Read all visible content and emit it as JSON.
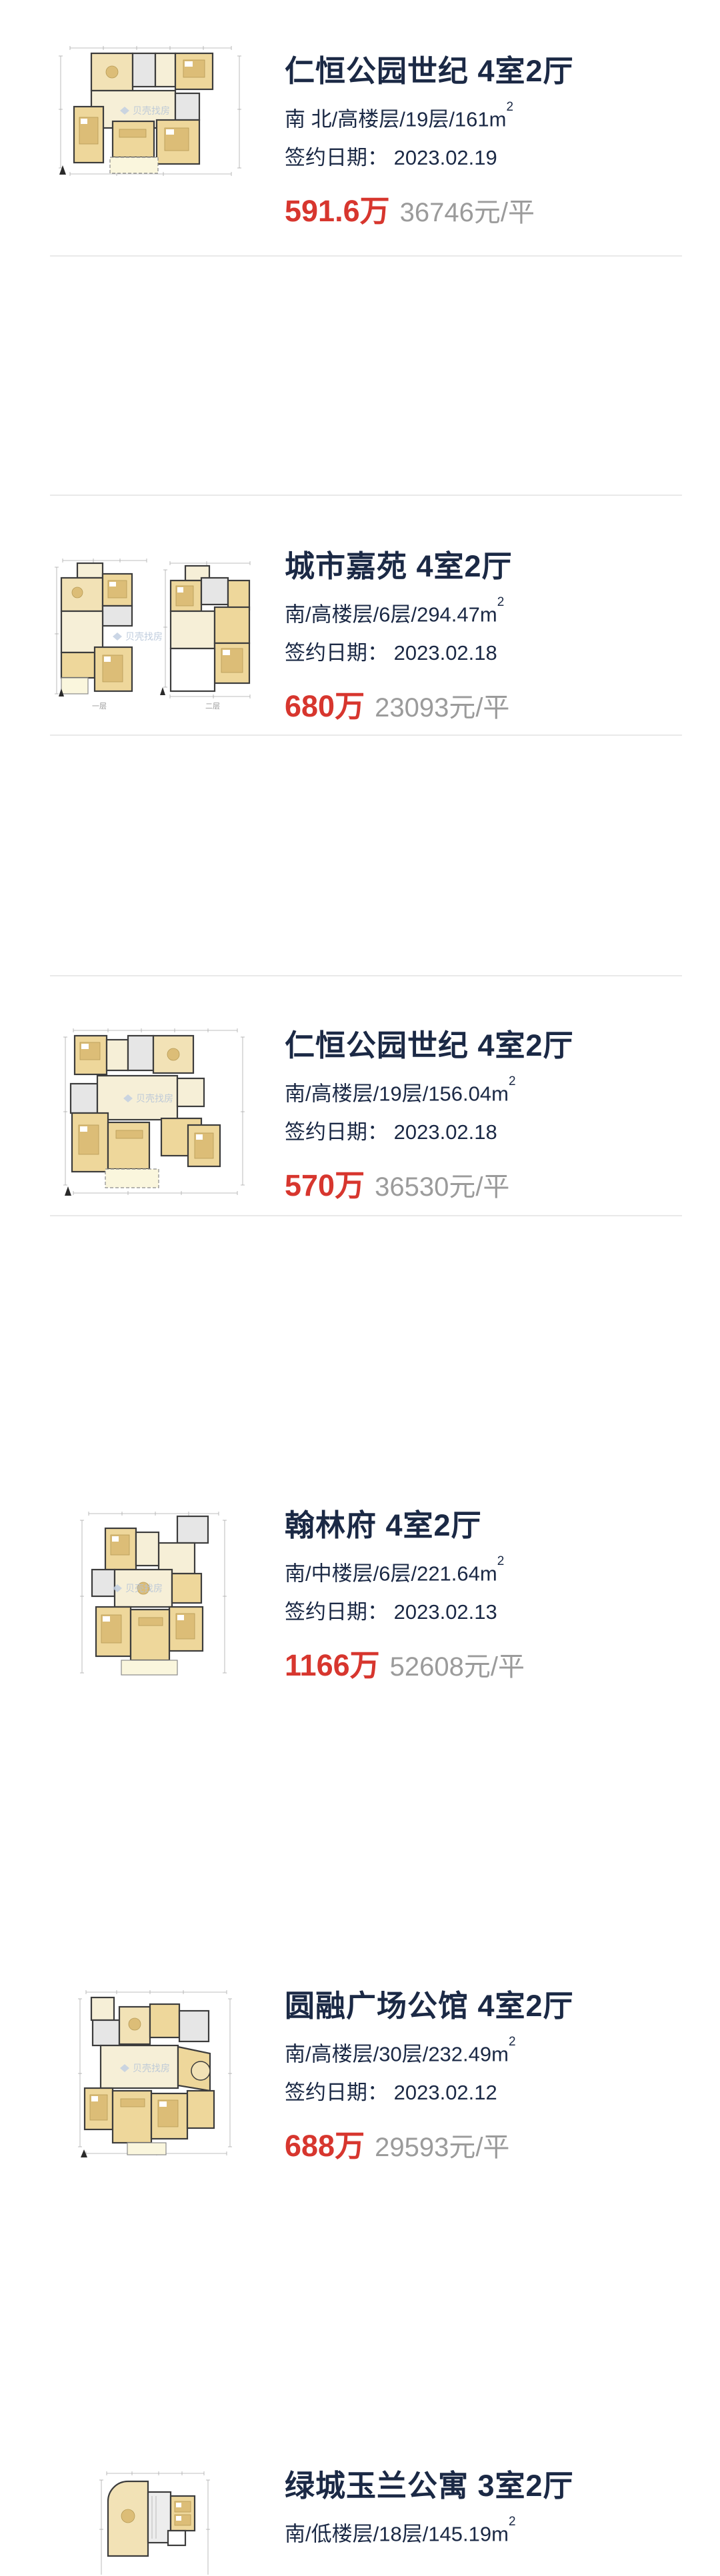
{
  "watermark": "贝壳找房",
  "listings": [
    {
      "title": "仁恒公园世纪 4室2厅",
      "specs": "南 北/高楼层/19层/161m",
      "specs_sup": "2",
      "date_line": "签约日期： 2023.02.19",
      "price": "591.6万",
      "unit_price": "36746元/平"
    },
    {
      "title": "城市嘉苑 4室2厅",
      "specs": "南/高楼层/6层/294.47m",
      "specs_sup": "2",
      "date_line": "签约日期： 2023.02.18",
      "price": "680万",
      "unit_price": "23093元/平",
      "floor_labels": [
        "一层",
        "二层"
      ]
    },
    {
      "title": "仁恒公园世纪 4室2厅",
      "specs": "南/高楼层/19层/156.04m",
      "specs_sup": "2",
      "date_line": "签约日期： 2023.02.18",
      "price": "570万",
      "unit_price": "36530元/平"
    },
    {
      "title": "翰林府 4室2厅",
      "specs": "南/中楼层/6层/221.64m",
      "specs_sup": "2",
      "date_line": "签约日期： 2023.02.13",
      "price": "1166万",
      "unit_price": "52608元/平"
    },
    {
      "title": "圆融广场公馆 4室2厅",
      "specs": "南/高楼层/30层/232.49m",
      "specs_sup": "2",
      "date_line": "签约日期： 2023.02.12",
      "price": "688万",
      "unit_price": "29593元/平"
    },
    {
      "title": "绿城玉兰公寓 3室2厅",
      "specs": "南/低楼层/18层/145.19m",
      "specs_sup": "2"
    }
  ]
}
